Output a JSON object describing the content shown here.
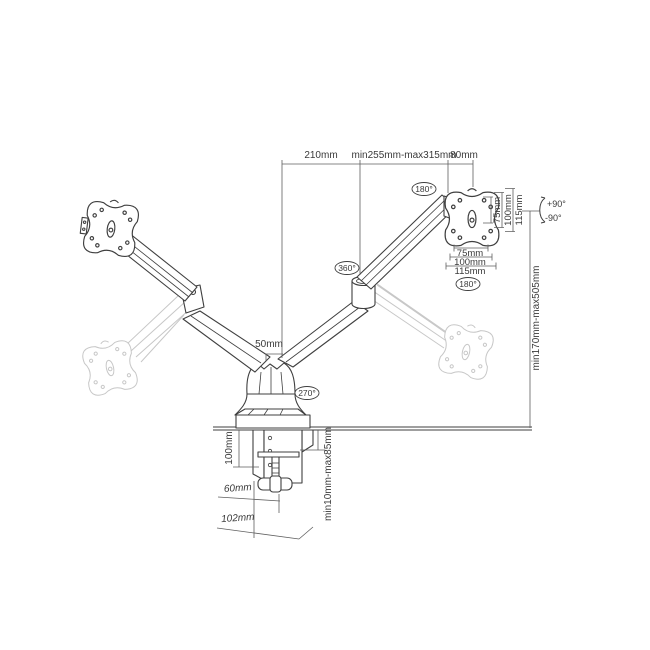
{
  "diagram_title": "Dual monitor desk mount arm - dimension drawing",
  "dimensions": {
    "top_left": "210mm",
    "top_middle": "min255mm-max315mm",
    "top_right": "80mm",
    "pole_diameter": "50mm",
    "height_range": "min170mm-max505mm",
    "clamp_height": "100mm",
    "desk_thickness_range": "min10mm-max85mm",
    "clamp_depth": "60mm",
    "base_depth": "102mm",
    "vesa_vertical": [
      "75mm",
      "100mm",
      "115mm"
    ],
    "vesa_horizontal": [
      "75mm",
      "100mm",
      "115mm"
    ]
  },
  "angles": {
    "rotation_arm_top": "180°",
    "rotation_swivel": "360°",
    "rotation_base": "270°",
    "rotation_plate": "180°",
    "tilt_up": "+90°",
    "tilt_down": "-90°"
  },
  "colors": {
    "ink": "#3f3f3f",
    "ghost": "#c7c7c7",
    "dim_line": "#5f5f5f",
    "text": "#3a3a3a",
    "background": "#ffffff"
  }
}
